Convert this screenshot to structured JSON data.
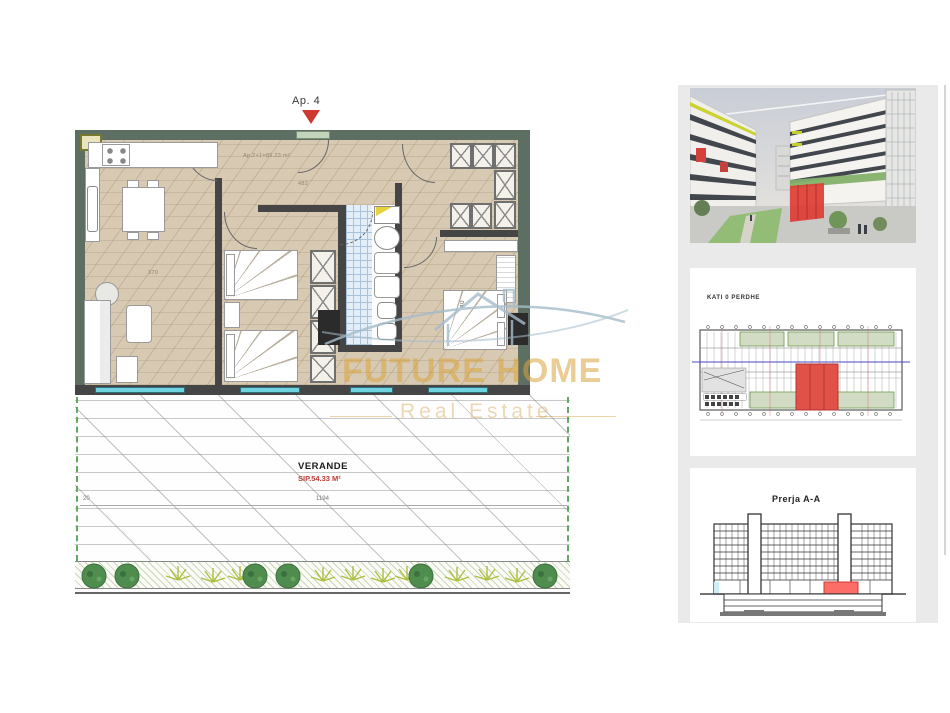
{
  "watermark": {
    "brand": "FUTURE HOME",
    "tagline": "Real Estate"
  },
  "plan": {
    "apartment_label": "Ap. 4",
    "unit_area_label": "Ap.2+1=85.23 m²",
    "veranda_label": "VERANDE",
    "veranda_area": "SIP.54.33 M²",
    "dim_labels": {
      "living": "370",
      "hall": "482",
      "bedroom": "40",
      "veranda_left": "20",
      "veranda_width": "1194"
    },
    "window_dims": [
      "240/240",
      "160/240",
      "150/80",
      "240/160"
    ],
    "colors": {
      "exterior_wall": "#5d6f62",
      "interior_wall": "#454545",
      "wood_floor": "#d8c9b2",
      "bathroom_tile": "#e4eef8",
      "window_cyan": "#6fd3e0",
      "marker_red": "#cf3732",
      "highlight_red": "#e04a42",
      "watermark_gold": "#d8a43c",
      "plant_green": "#4f8d4f"
    }
  },
  "sidebar": {
    "thumbnails": [
      {
        "name": "exterior-render"
      },
      {
        "name": "ground-floor-plan",
        "title": "KATI 0 PERDHE"
      },
      {
        "name": "building-section",
        "title": "Prerja A-A"
      }
    ]
  }
}
